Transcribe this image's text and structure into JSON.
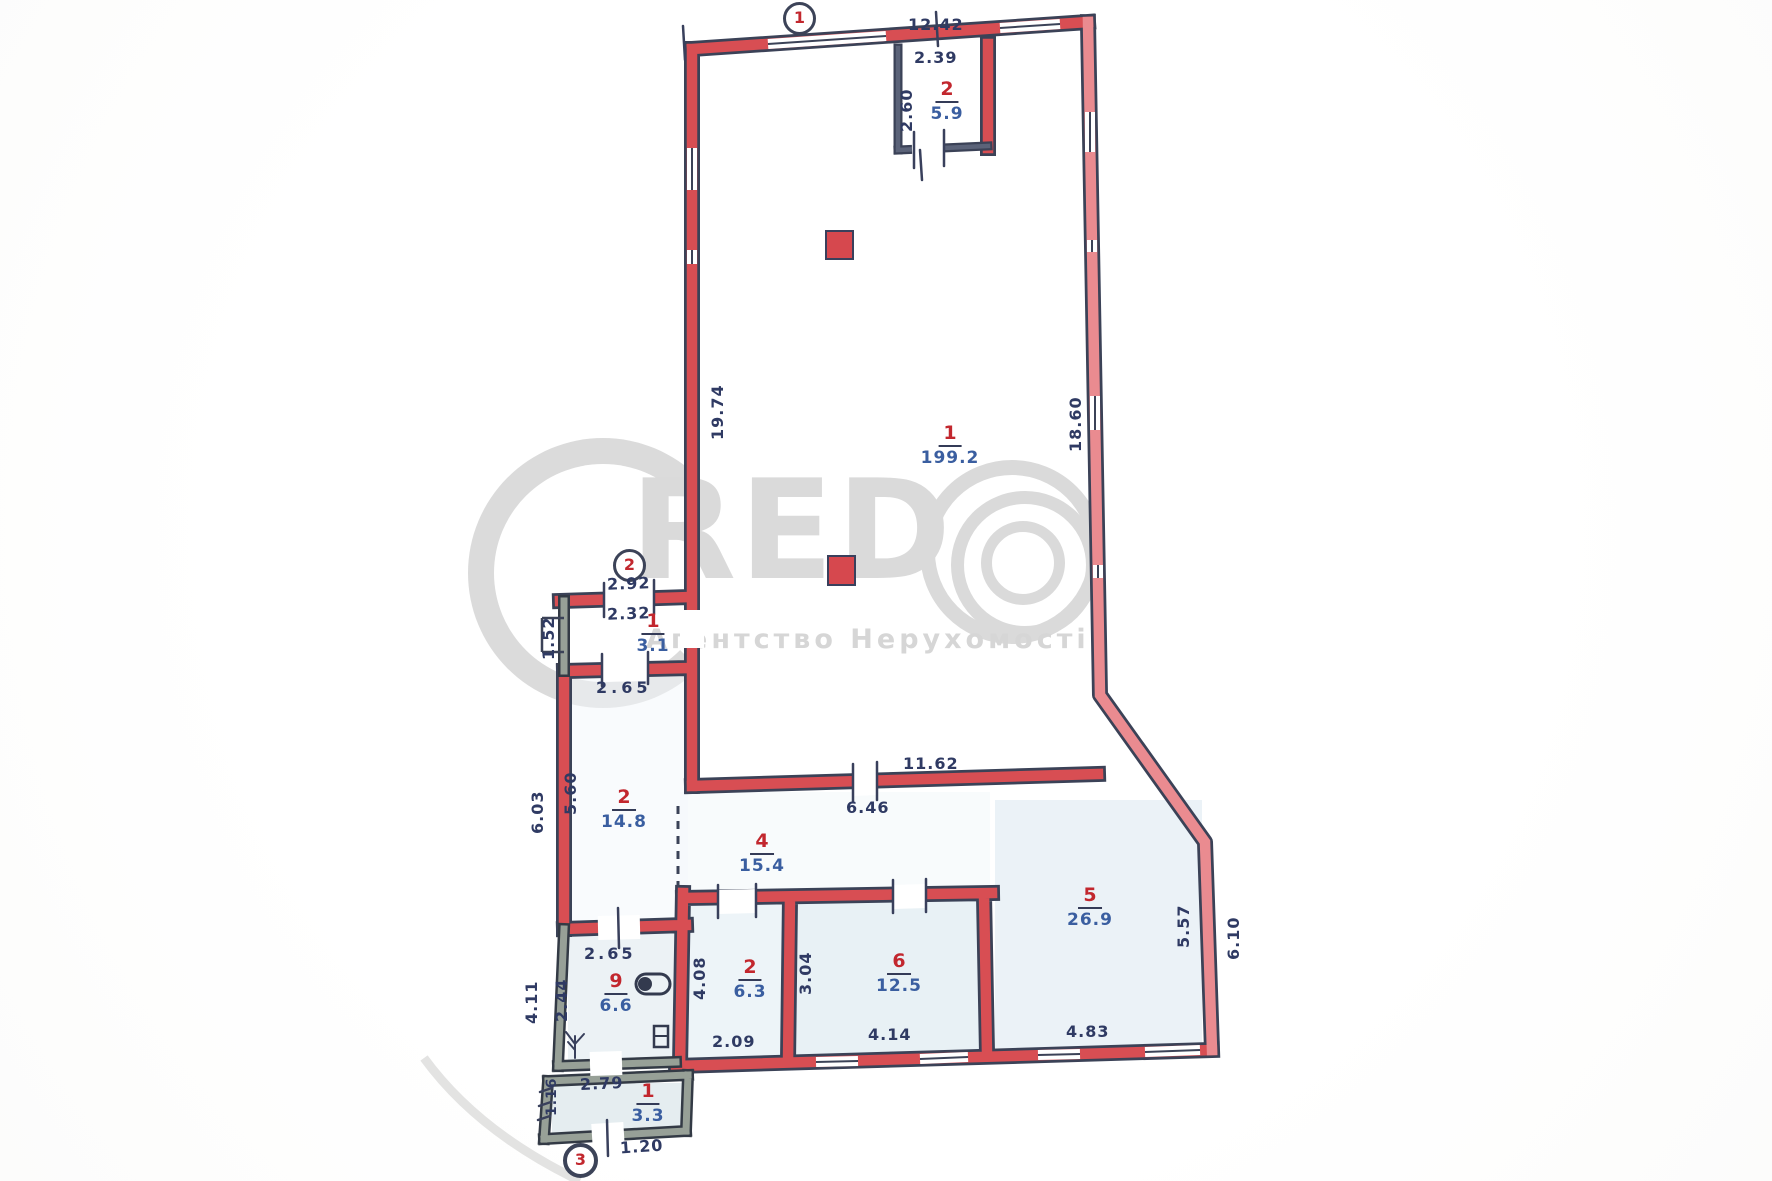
{
  "watermark": {
    "brand": "RED",
    "subtitle": "Агентство Нерухомості"
  },
  "entrances": [
    {
      "label": "1"
    },
    {
      "label": "2"
    },
    {
      "label": "3"
    }
  ],
  "rooms": [
    {
      "id": "hall",
      "number": "1",
      "area": "199.2"
    },
    {
      "id": "top-room",
      "number": "2",
      "area": "5.9"
    },
    {
      "id": "porch",
      "number": "1",
      "area": "3.1"
    },
    {
      "id": "room-left",
      "number": "2",
      "area": "14.8"
    },
    {
      "id": "boiler",
      "number": "9",
      "area": "6.6"
    },
    {
      "id": "annex",
      "number": "1",
      "area": "3.3"
    },
    {
      "id": "room4",
      "number": "4",
      "area": "15.4"
    },
    {
      "id": "room2b",
      "number": "2",
      "area": "6.3"
    },
    {
      "id": "room6",
      "number": "6",
      "area": "12.5"
    },
    {
      "id": "room5",
      "number": "5",
      "area": "26.9"
    }
  ],
  "dims": {
    "top_width": "12.42",
    "top_room_width": "2.39",
    "top_room_depth": "2.60",
    "hall_left": "19.74",
    "hall_right": "18.60",
    "hall_bottom": "11.62",
    "porch_out": "2.92",
    "porch_in": "2.32",
    "porch_depth": "1.52",
    "room_left_top": "2.65",
    "room_left_bottom": "2.65",
    "room_left_in": "5.60",
    "room_left_out": "6.03",
    "room4_width": "6.46",
    "room2b_width": "2.09",
    "room2b_left": "4.08",
    "room2b_right": "3.04",
    "room6_width": "4.14",
    "room5_width": "4.83",
    "room5_in": "5.57",
    "room5_out": "6.10",
    "boiler_out": "4.11",
    "boiler_in": "2.44",
    "annex_width": "2.79",
    "annex_left": "1.16",
    "annex_door": "1.20"
  },
  "colors": {
    "wall_red": "#d84e53",
    "ink": "#3b4257",
    "room_number": "#c2272e",
    "area_ink": "#3a5ea0"
  }
}
